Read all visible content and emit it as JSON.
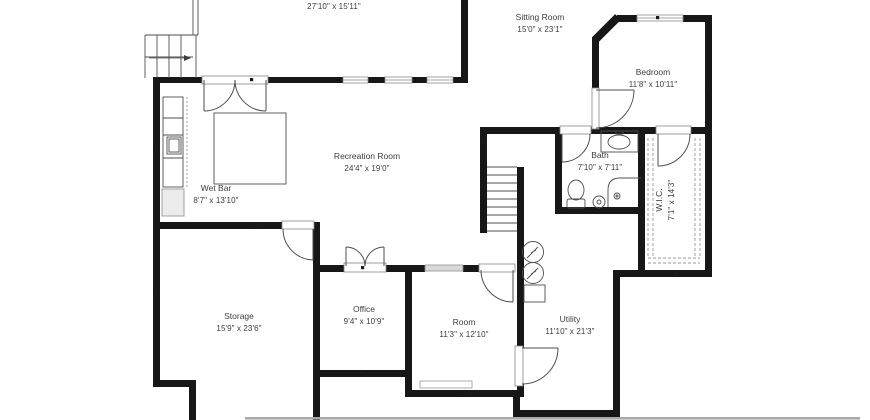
{
  "plan": {
    "title": "Basement floor plan",
    "colors": {
      "wall": "#171717",
      "thin_line": "#4e4e4e",
      "label_text": "#3d3d3d",
      "window_gray": "#d9d9d9",
      "watermark_gray": "#a9a9a9"
    },
    "rooms": [
      {
        "id": "top-room",
        "name": "",
        "dims": "27'10\" x 15'11\""
      },
      {
        "id": "sitting-room",
        "name": "Sitting Room",
        "dims": "15'0\" x 23'1\""
      },
      {
        "id": "bedroom",
        "name": "Bedroom",
        "dims": "11'8\" x 10'11\""
      },
      {
        "id": "recreation-room",
        "name": "Recreation Room",
        "dims": "24'4\" x 19'0\""
      },
      {
        "id": "wet-bar",
        "name": "Wet Bar",
        "dims": "8'7\" x 13'10\""
      },
      {
        "id": "bath",
        "name": "Bath",
        "dims": "7'10\" x 7'11\""
      },
      {
        "id": "wic",
        "name": "W.I.C.",
        "dims": "7'1\" x 14'3\""
      },
      {
        "id": "storage",
        "name": "Storage",
        "dims": "15'9\" x 23'6\""
      },
      {
        "id": "office",
        "name": "Office",
        "dims": "9'4\" x 10'9\""
      },
      {
        "id": "room",
        "name": "Room",
        "dims": "11'3\" x 12'10\""
      },
      {
        "id": "utility",
        "name": "Utility",
        "dims": "11'10\" x 21'3\""
      }
    ]
  }
}
